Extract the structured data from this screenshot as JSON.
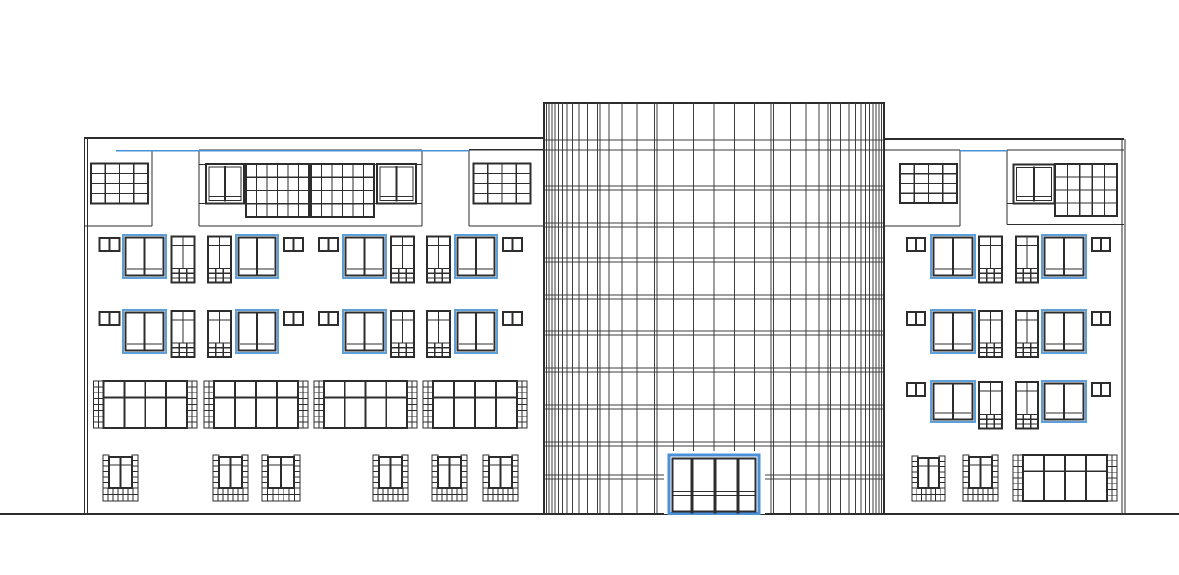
{
  "canvas": {
    "width": 1179,
    "height": 575,
    "background": "#ffffff"
  },
  "colors": {
    "line": "#2d2d2d",
    "thin": "#3f3f3f",
    "blue": "#4a90d8",
    "window_blue": "#5d9fd9",
    "white": "#ffffff"
  },
  "ground_line": {
    "x1": 0,
    "y": 514,
    "x2": 1179,
    "sw": 2
  },
  "tower": {
    "x": 544,
    "y": 103,
    "w": 340,
    "h": 411,
    "mullions_x": [
      546.5,
      549,
      552,
      555,
      558.5,
      562.5,
      567,
      572.5,
      579,
      587.5,
      597.5,
      600,
      609,
      622,
      637,
      654.5,
      657,
      673.5,
      693.5,
      714,
      734.5,
      754.5,
      771,
      773.5,
      790.5,
      806,
      819,
      828,
      830.5,
      840.5,
      849,
      855.5,
      861,
      865.5,
      869.5,
      873,
      876,
      879,
      881.5
    ],
    "floors_y": [
      140,
      150,
      186,
      190,
      223,
      227,
      258,
      262,
      295,
      299,
      331,
      335,
      368,
      372,
      405,
      409,
      442,
      446,
      475,
      479
    ]
  },
  "entrance_door": {
    "mask": {
      "x": 664,
      "y": 451,
      "w": 101,
      "h": 63
    },
    "frame": {
      "x": 669,
      "y": 455,
      "w": 90,
      "h": 58.5
    },
    "inner": {
      "x": 672.5,
      "y": 458.5,
      "w": 83,
      "h": 53
    },
    "mullions_x": [
      692,
      715,
      738
    ],
    "transoms_y": [
      491.5,
      495.5
    ]
  },
  "wings": [
    {
      "name": "left-wing",
      "top_line": [
        84,
        138,
        544,
        138
      ],
      "edges": [
        [
          84.5,
          138,
          84.5,
          514
        ],
        [
          87.5,
          138,
          87.5,
          514
        ]
      ],
      "blue_line": {
        "x1": 116,
        "y": 150.8,
        "x2": 469
      },
      "structure_lines": [
        [
          152,
          150.5,
          152,
          226
        ],
        [
          84,
          226,
          152,
          226
        ],
        [
          199,
          150,
          422,
          150
        ],
        [
          199,
          150,
          199,
          226
        ],
        [
          422,
          150,
          422,
          226
        ],
        [
          199,
          226,
          422,
          226
        ],
        [
          199,
          164.5,
          422,
          164.5
        ],
        [
          199,
          203.5,
          247,
          203.5
        ],
        [
          373,
          203.5,
          422,
          203.5
        ],
        [
          469,
          149.8,
          544,
          149.8
        ],
        [
          469,
          149.8,
          469,
          226
        ],
        [
          469,
          226,
          544,
          226
        ]
      ],
      "panel_windows": [
        {
          "t": "grid",
          "x": 91,
          "y": 163.5,
          "w": 57,
          "h": 40,
          "cols": 4,
          "rows": 4
        },
        {
          "t": "pane2",
          "x": 206,
          "y": 164,
          "w": 38,
          "h": 39.5
        },
        {
          "t": "grid",
          "x": 246,
          "y": 164,
          "w": 63,
          "h": 53,
          "cols": 6,
          "rows": 4
        },
        {
          "t": "grid",
          "x": 311,
          "y": 164,
          "w": 63,
          "h": 53,
          "cols": 6,
          "rows": 4
        },
        {
          "t": "pane2",
          "x": 377,
          "y": 164,
          "w": 39,
          "h": 39.5
        },
        {
          "t": "grid",
          "x": 473.5,
          "y": 163.5,
          "w": 57,
          "h": 40,
          "cols": 4,
          "rows": 4
        }
      ],
      "windows": [
        {
          "t": "vent",
          "x": 99.5,
          "y": 238,
          "w": 20,
          "h": 13
        },
        {
          "t": "blue",
          "x": 123,
          "y": 235,
          "w": 43,
          "h": 43
        },
        {
          "t": "narrow",
          "x": 171.5,
          "y": 236.5,
          "w": 23,
          "h": 46
        },
        {
          "t": "narrow",
          "x": 208,
          "y": 236.5,
          "w": 23,
          "h": 46
        },
        {
          "t": "blue",
          "x": 236,
          "y": 235,
          "w": 42,
          "h": 43
        },
        {
          "t": "vent",
          "x": 284,
          "y": 238,
          "w": 19,
          "h": 13
        },
        {
          "t": "vent",
          "x": 319,
          "y": 238,
          "w": 19,
          "h": 13
        },
        {
          "t": "blue",
          "x": 343,
          "y": 235,
          "w": 43,
          "h": 43
        },
        {
          "t": "narrow",
          "x": 391,
          "y": 236.5,
          "w": 23,
          "h": 46
        },
        {
          "t": "narrow",
          "x": 427,
          "y": 236.5,
          "w": 23,
          "h": 46
        },
        {
          "t": "blue",
          "x": 455,
          "y": 235,
          "w": 42,
          "h": 43
        },
        {
          "t": "vent",
          "x": 503,
          "y": 238,
          "w": 19,
          "h": 13
        },
        {
          "t": "vent",
          "x": 99.5,
          "y": 312,
          "w": 20,
          "h": 13
        },
        {
          "t": "blue",
          "x": 123,
          "y": 310,
          "w": 43,
          "h": 43
        },
        {
          "t": "narrow",
          "x": 171.5,
          "y": 311,
          "w": 23,
          "h": 46
        },
        {
          "t": "narrow",
          "x": 208,
          "y": 311,
          "w": 23,
          "h": 46
        },
        {
          "t": "blue",
          "x": 236,
          "y": 310,
          "w": 42,
          "h": 43
        },
        {
          "t": "vent",
          "x": 284,
          "y": 312,
          "w": 19,
          "h": 13
        },
        {
          "t": "vent",
          "x": 319,
          "y": 312,
          "w": 19,
          "h": 13
        },
        {
          "t": "blue",
          "x": 343,
          "y": 310,
          "w": 43,
          "h": 43
        },
        {
          "t": "narrow",
          "x": 391,
          "y": 311,
          "w": 23,
          "h": 46
        },
        {
          "t": "narrow",
          "x": 427,
          "y": 311,
          "w": 23,
          "h": 46
        },
        {
          "t": "blue",
          "x": 455,
          "y": 310,
          "w": 42,
          "h": 43
        },
        {
          "t": "vent",
          "x": 503,
          "y": 312,
          "w": 19,
          "h": 13
        },
        {
          "t": "store",
          "x": 93.5,
          "y": 381,
          "w": 103.5,
          "h": 47
        },
        {
          "t": "store",
          "x": 204,
          "y": 381,
          "w": 104,
          "h": 47
        },
        {
          "t": "store",
          "x": 314,
          "y": 381,
          "w": 103,
          "h": 47
        },
        {
          "t": "store",
          "x": 423,
          "y": 381,
          "w": 104,
          "h": 47
        },
        {
          "t": "brick",
          "x": 103,
          "y": 455,
          "w": 35,
          "h": 46
        },
        {
          "t": "brick",
          "x": 213,
          "y": 455,
          "w": 35,
          "h": 46
        },
        {
          "t": "brick",
          "x": 262,
          "y": 455,
          "w": 38,
          "h": 46
        },
        {
          "t": "brick",
          "x": 373,
          "y": 455,
          "w": 35,
          "h": 46
        },
        {
          "t": "brick",
          "x": 432,
          "y": 455,
          "w": 35,
          "h": 46
        },
        {
          "t": "brick",
          "x": 483,
          "y": 455,
          "w": 35,
          "h": 46
        }
      ]
    },
    {
      "name": "right-wing",
      "top_line": [
        884,
        139,
        1124,
        139
      ],
      "edges": [
        [
          1122,
          139,
          1122,
          514
        ],
        [
          1125,
          139,
          1125,
          514
        ]
      ],
      "blue_line": {
        "x1": 960,
        "y": 150.8,
        "x2": 1007
      },
      "structure_lines": [
        [
          884,
          150,
          960,
          150
        ],
        [
          960,
          150,
          960,
          226
        ],
        [
          884,
          226,
          960,
          226
        ],
        [
          1007,
          150,
          1124,
          150
        ],
        [
          1007,
          150,
          1007,
          224.5
        ],
        [
          1007,
          224.5,
          1124,
          224.5
        ],
        [
          1007,
          203.5,
          1055,
          203.5
        ]
      ],
      "panel_windows": [
        {
          "t": "grid",
          "x": 900,
          "y": 164,
          "w": 57,
          "h": 39,
          "cols": 4,
          "rows": 4
        },
        {
          "t": "pane2",
          "x": 1013.5,
          "y": 164.5,
          "w": 41,
          "h": 39
        },
        {
          "t": "grid",
          "x": 1055,
          "y": 164,
          "w": 62,
          "h": 52,
          "cols": 5,
          "rows": 4
        }
      ],
      "windows": [
        {
          "t": "vent",
          "x": 907,
          "y": 238,
          "w": 18,
          "h": 13
        },
        {
          "t": "blue",
          "x": 931,
          "y": 235,
          "w": 44,
          "h": 43
        },
        {
          "t": "narrow",
          "x": 979,
          "y": 236.5,
          "w": 23,
          "h": 46
        },
        {
          "t": "narrow",
          "x": 1016,
          "y": 236.5,
          "w": 22,
          "h": 46
        },
        {
          "t": "blue",
          "x": 1042,
          "y": 235,
          "w": 44,
          "h": 43
        },
        {
          "t": "vent",
          "x": 1092,
          "y": 238,
          "w": 18,
          "h": 13
        },
        {
          "t": "vent",
          "x": 907,
          "y": 312,
          "w": 18,
          "h": 13
        },
        {
          "t": "blue",
          "x": 931,
          "y": 310,
          "w": 44,
          "h": 43
        },
        {
          "t": "narrow",
          "x": 979,
          "y": 311,
          "w": 23,
          "h": 46
        },
        {
          "t": "narrow",
          "x": 1016,
          "y": 311,
          "w": 22,
          "h": 46
        },
        {
          "t": "blue",
          "x": 1042,
          "y": 310,
          "w": 44,
          "h": 43
        },
        {
          "t": "vent",
          "x": 1092,
          "y": 312,
          "w": 18,
          "h": 13
        },
        {
          "t": "vent",
          "x": 907,
          "y": 383,
          "w": 18,
          "h": 13
        },
        {
          "t": "blue",
          "x": 931,
          "y": 381,
          "w": 44,
          "h": 41
        },
        {
          "t": "narrow",
          "x": 979,
          "y": 382,
          "w": 23,
          "h": 46.5
        },
        {
          "t": "narrow",
          "x": 1016,
          "y": 382,
          "w": 22,
          "h": 46.5
        },
        {
          "t": "blue",
          "x": 1042,
          "y": 381,
          "w": 44,
          "h": 41
        },
        {
          "t": "vent",
          "x": 1092,
          "y": 383,
          "w": 18,
          "h": 13
        },
        {
          "t": "brick",
          "x": 912,
          "y": 456,
          "w": 33,
          "h": 45
        },
        {
          "t": "brick",
          "x": 963,
          "y": 455,
          "w": 35,
          "h": 46
        },
        {
          "t": "store",
          "x": 1013,
          "y": 455,
          "w": 104,
          "h": 46
        }
      ]
    }
  ]
}
